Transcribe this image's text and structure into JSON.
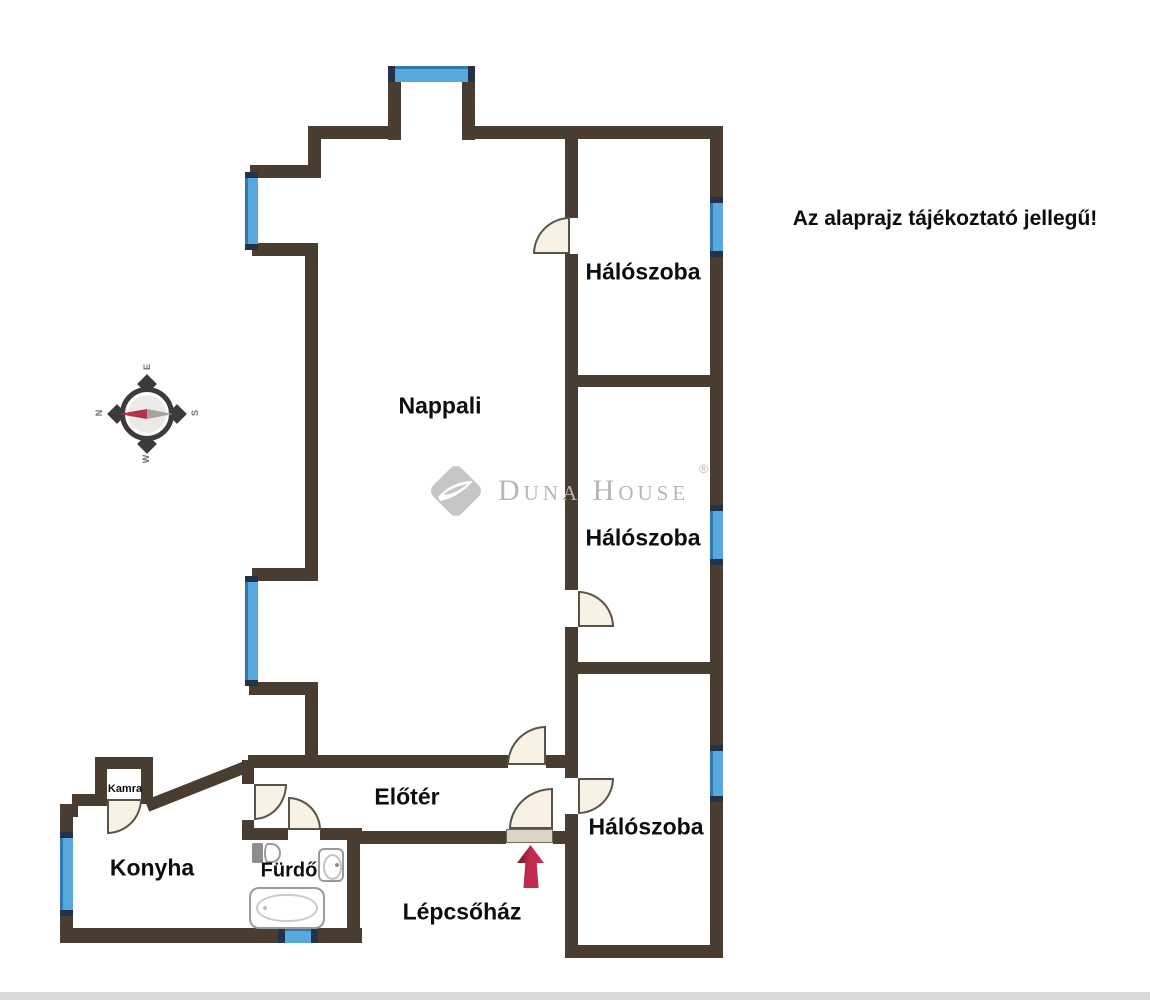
{
  "title": "Az alaprajz tájékoztató jellegű!",
  "watermark": {
    "brand": "Duna House",
    "registered": "®"
  },
  "rooms": {
    "nappali": "Nappali",
    "haloszoba_1": "Hálószoba",
    "haloszoba_2": "Hálószoba",
    "haloszoba_3": "Hálószoba",
    "konyha": "Konyha",
    "kamra": "Kamra",
    "furdo": "Fürdő",
    "eloter": "Előtér",
    "lepcsohaz": "Lépcsőház"
  },
  "compass": {
    "top": "E",
    "left": "N",
    "right": "S",
    "bottom": "W"
  },
  "icons": {
    "compass": "compass-rose-icon",
    "entrance": "entrance-arrow-icon",
    "bathtub": "bathtub-icon",
    "toilet": "toilet-icon",
    "sink": "sink-icon",
    "logo": "duna-house-diamond-icon"
  },
  "colors": {
    "wall": "#493c31",
    "window": "#57a9dc",
    "window_cap": "#233249",
    "window_edge": "#2e79b1",
    "door_fill": "#f7f1e6",
    "door_line": "#5a5349",
    "threshold": "#dcd5c7",
    "arrow": "#c32b50",
    "arrow_dark": "#8c1e38",
    "compass_red": "#b5344c",
    "watermark": "#b6b6b6",
    "text": "#0d0d0d"
  }
}
